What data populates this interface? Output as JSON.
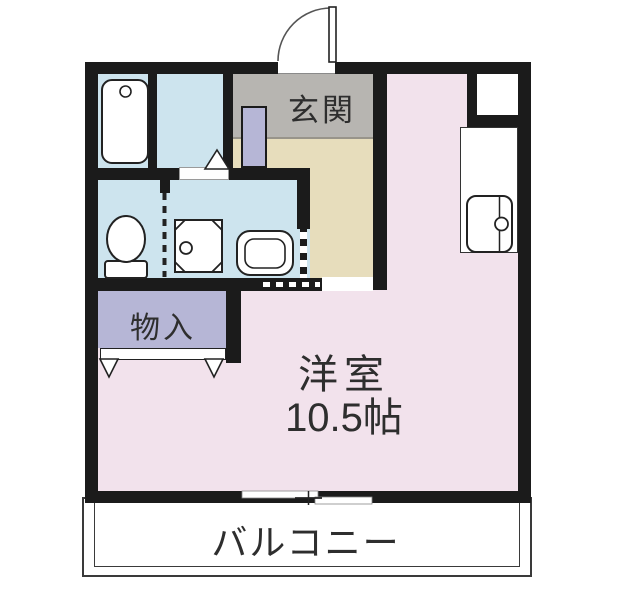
{
  "plan": {
    "type": "apartment-floor-plan",
    "labels": {
      "genkan": "玄関",
      "storage": "物入",
      "main_room_name": "洋室",
      "main_room_size": "10.5帖",
      "balcony": "バルコニー"
    },
    "colors": {
      "wall": "#1b1b1b",
      "western_room_pink": "#f2e2ec",
      "wet_area_blue": "#cde4ee",
      "genkan_gray": "#b7b5b1",
      "hallway_beige": "#e7ddbc",
      "closet_lavender": "#b6b6d6",
      "fixture_white": "#ffffff"
    },
    "fixtures": [
      "bathtub",
      "toilet",
      "washing-machine-pan",
      "washbasin",
      "kitchen-sink",
      "pipe-space-box",
      "shoe-cabinet",
      "entrance-swing-door",
      "bath-swing-door",
      "closet-double-doors",
      "accordion-partitions",
      "sliding-window-to-balcony"
    ]
  }
}
